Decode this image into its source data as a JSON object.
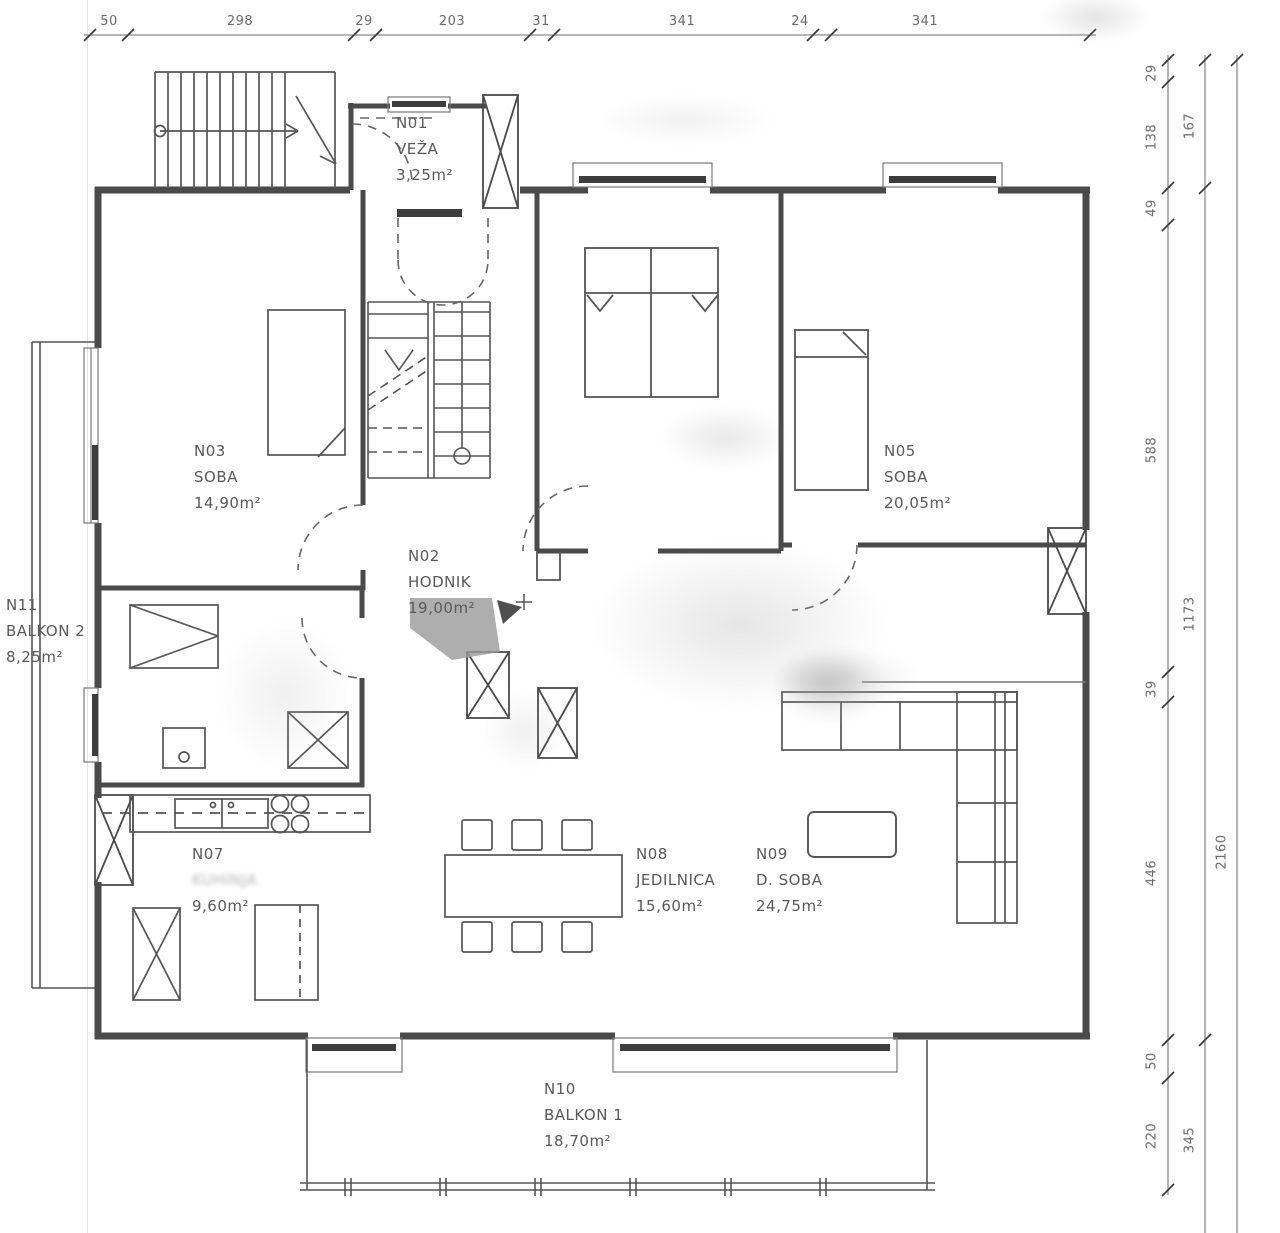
{
  "title": "Floor plan - apartment level",
  "colors": {
    "line": "#4a4a4a",
    "dim_text": "#6b6b6b",
    "label_text": "#595959",
    "dark_fill": "#3d3d3d"
  },
  "rooms": [
    {
      "id": "N01",
      "name": "VEŽA",
      "area": "3,25m²"
    },
    {
      "id": "N02",
      "name": "HODNIK",
      "area": "19,00m²"
    },
    {
      "id": "N03",
      "name": "SOBA",
      "area": "14,90m²"
    },
    {
      "id": "N05",
      "name": "SOBA",
      "area": "20,05m²"
    },
    {
      "id": "N07",
      "name": "KUHINJA",
      "area": "9,60m²"
    },
    {
      "id": "N08",
      "name": "JEDILNICA",
      "area": "15,60m²"
    },
    {
      "id": "N09",
      "name": "D. SOBA",
      "area": "24,75m²"
    },
    {
      "id": "N10",
      "name": "BALKON 1",
      "area": "18,70m²"
    },
    {
      "id": "N11",
      "name": "BALKON 2",
      "area": "8,25m²"
    }
  ],
  "dims": {
    "top": [
      "50",
      "298",
      "29",
      "203",
      "31",
      "341",
      "24",
      "341"
    ],
    "right_inner": [
      "29",
      "138",
      "49",
      "588",
      "39",
      "446",
      "50",
      "220"
    ],
    "right_mid": [
      "167",
      "1173",
      "345"
    ],
    "right_outer": [
      "2160"
    ]
  }
}
